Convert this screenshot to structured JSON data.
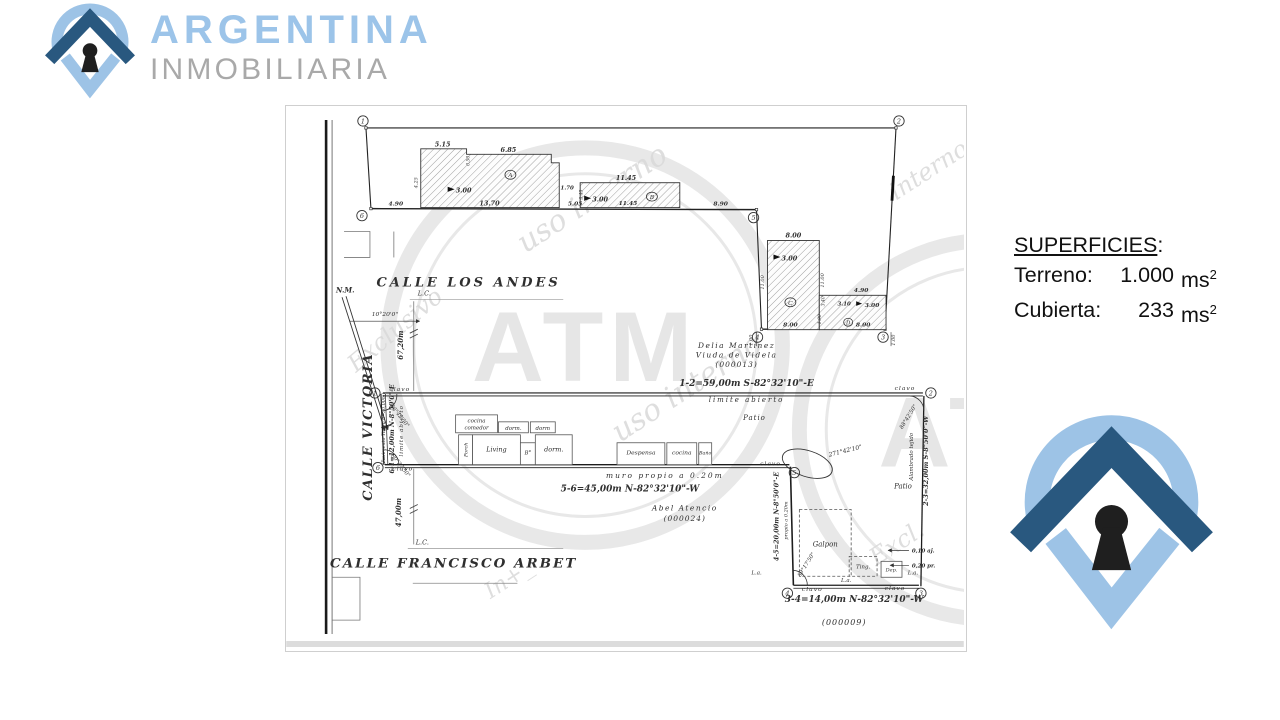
{
  "brand": {
    "line1": "ARGENTINA",
    "line2": "INMOBILIARIA",
    "blue_text": "#9cc4e9",
    "gray_text": "#a9a9a9",
    "dark_blue": "#29587f",
    "light_blue": "#9dc3e6",
    "keyhole": "#1f1f1f"
  },
  "superficies": {
    "title": "SUPERFICIES",
    "colon": ":",
    "rows": [
      {
        "label": "Terreno:",
        "num": "1.000",
        "unit": "ms",
        "sup": "2"
      },
      {
        "label": "Cubierta:",
        "num": "233",
        "unit": "ms",
        "sup": "2"
      }
    ]
  },
  "plan": {
    "streets": {
      "los_andes": "CALLE LOS ANDES",
      "victoria": "CALLE VICTORIA",
      "victoria_note": "(Pavimento Tierra a=30,00m)",
      "francisco_arbet": "CALLE FRANCISCO ARBET"
    },
    "north": {
      "label": "N.M.",
      "angle": "10°20'0\""
    },
    "lc": "L.C.",
    "measures": {
      "victoria_north": "67,20m",
      "victoria_south": "47,00m"
    },
    "owners": {
      "north1": "Delia Martinez",
      "north2": "Viuda de Videla",
      "north3": "(000013)",
      "south1": "Abel Atencio",
      "south2": "(000024)",
      "southeast": "(000009)"
    },
    "courses": {
      "c12": "1-2=59,00m  S-82°32'10\"-E",
      "c56": "5-6=45,00m  N-82°32'10\"-W",
      "c61": "6-1=12,00m  N-8°50'0\"-E",
      "c23": "2-3=32,00m  S-8°50'0\"-W",
      "c45": "4-5=20,00m  N-8°50'0\"-E",
      "c34": "3-4=14,00m  N-82°32'10\"-W"
    },
    "notes": {
      "limite_top": "limite abierto",
      "limite_left": "limite abierto",
      "muro": "muro propio a 0.20m",
      "propio": "propio a 0.20m",
      "alambrado": "Alambrado tejido",
      "patio_n": "Patio",
      "patio_se": "Patio",
      "off_010": "0,10 aj.",
      "off_020": "0,20 pr.",
      "la": "L.a.",
      "clavo": "clavo"
    },
    "angles": {
      "a1": "86°42'50\"",
      "a2": "88°42'50\"",
      "a4": "89°17'50\"",
      "a5": "271°42'10\"",
      "a6": "80°27'50\""
    },
    "corners": {
      "n1": "1",
      "n2": "2",
      "n3": "3",
      "n4": "4",
      "n5": "5",
      "n6": "6"
    },
    "blocks": {
      "a": "A",
      "b": "B",
      "c": "C",
      "d": "D"
    },
    "rooms": {
      "cocina1": "cocina",
      "comedor": "comedor",
      "dorm1": "dorm.",
      "dorm2": "dorm",
      "porch": "Porch",
      "living": "Living",
      "bano1": "B°",
      "dorm3": "dorm.",
      "despensa": "Despensa",
      "cocina2": "cocina",
      "bano2": "Baño",
      "galpon": "Galpon",
      "ting": "Ting.",
      "dep": "Dep."
    },
    "dims": {
      "a_t1": "5.15",
      "a_t2": "6.85",
      "a_step": "0.50",
      "a_r": "1.70",
      "a_l": "4.25",
      "a_b": "13.70",
      "h3a": "3.00",
      "w490": "4.90",
      "w505": "5.05",
      "b_t": "11.45",
      "b_b": "11.45",
      "b_s": "3.45",
      "h3b": "3.00",
      "w890": "8.90",
      "c_t": "8.00",
      "c_l": "11.00",
      "c_r": "11.00",
      "c_b": "8.00",
      "h3c": "3.00",
      "d_t": "4.90",
      "d_310": "3.10",
      "d_340": "3.40",
      "d_190": "1.90",
      "h3d": "3.00",
      "d_b": "8.00",
      "off1": "1.00",
      "off2": "1.00"
    },
    "watermark": {
      "atm": "ATM",
      "t1": "uso interno",
      "t2": "Exclusivo",
      "t3": "interno",
      "t4": "Excl.",
      "t5": "In+_"
    }
  }
}
